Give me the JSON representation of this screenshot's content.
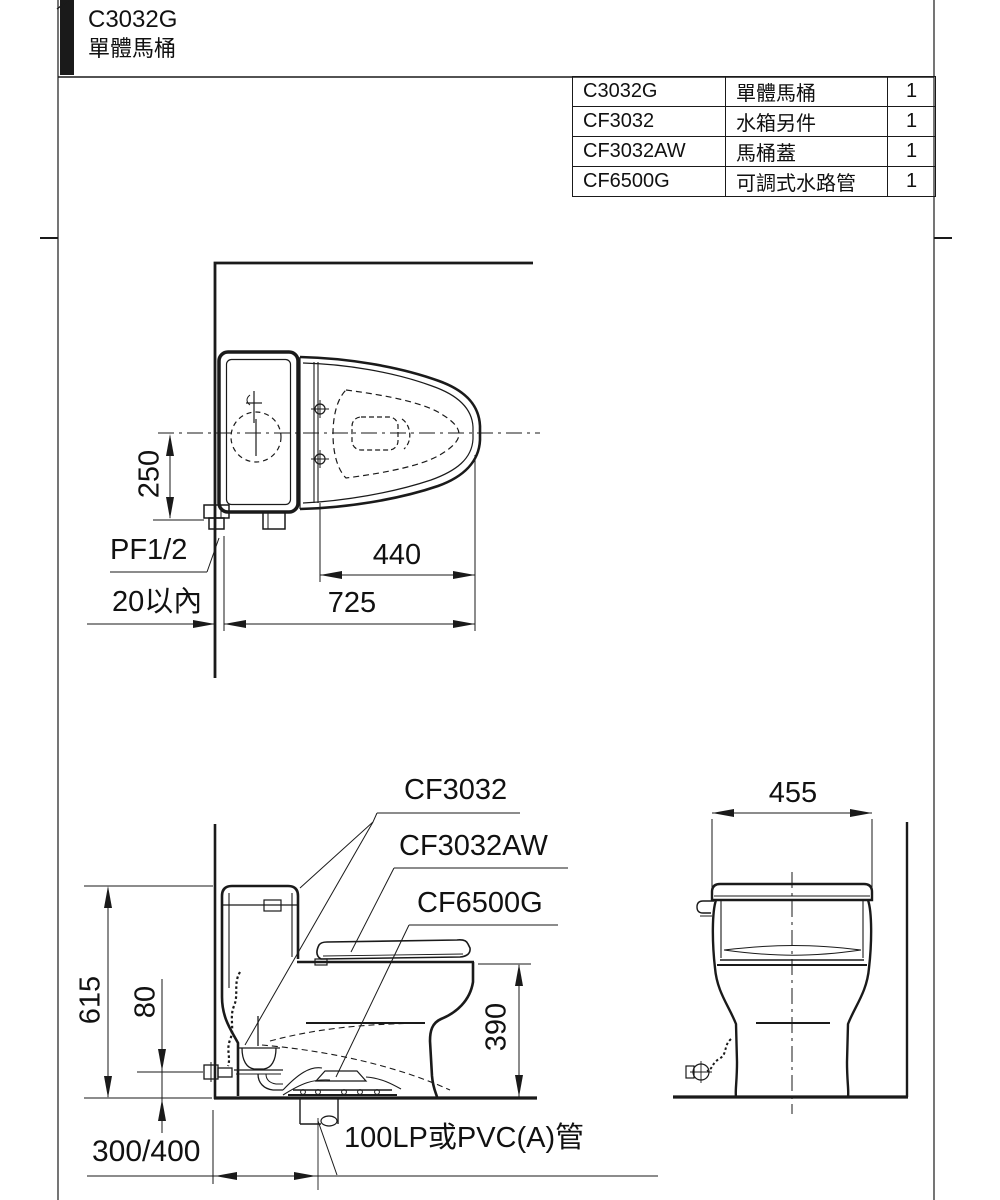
{
  "colors": {
    "ink": "#1a1a1a",
    "paper": "#ffffff"
  },
  "header": {
    "model": "C3032G",
    "name": "單體馬桶"
  },
  "parts_table": {
    "rows": [
      {
        "code": "C3032G",
        "name": "單體馬桶",
        "qty": "1"
      },
      {
        "code": "CF3032",
        "name": "水箱另件",
        "qty": "1"
      },
      {
        "code": "CF3032AW",
        "name": "馬桶蓋",
        "qty": "1"
      },
      {
        "code": "CF6500G",
        "name": "可調式水路管",
        "qty": "1"
      }
    ]
  },
  "top_view": {
    "dim_tank_width": "250",
    "supply_label": "PF1/2",
    "wall_gap": "20以內",
    "dim_seat_length": "440",
    "dim_total_length": "725"
  },
  "side_view": {
    "callout_tank_parts": "CF3032",
    "callout_seat_cover": "CF3032AW",
    "callout_water_pipe": "CF6500G",
    "dim_total_height": "615",
    "dim_inlet_height": "80",
    "dim_rim_height": "390",
    "dim_rough_in": "300/400",
    "drain_note": "100LP或PVC(A)管"
  },
  "front_view": {
    "dim_width": "455"
  }
}
